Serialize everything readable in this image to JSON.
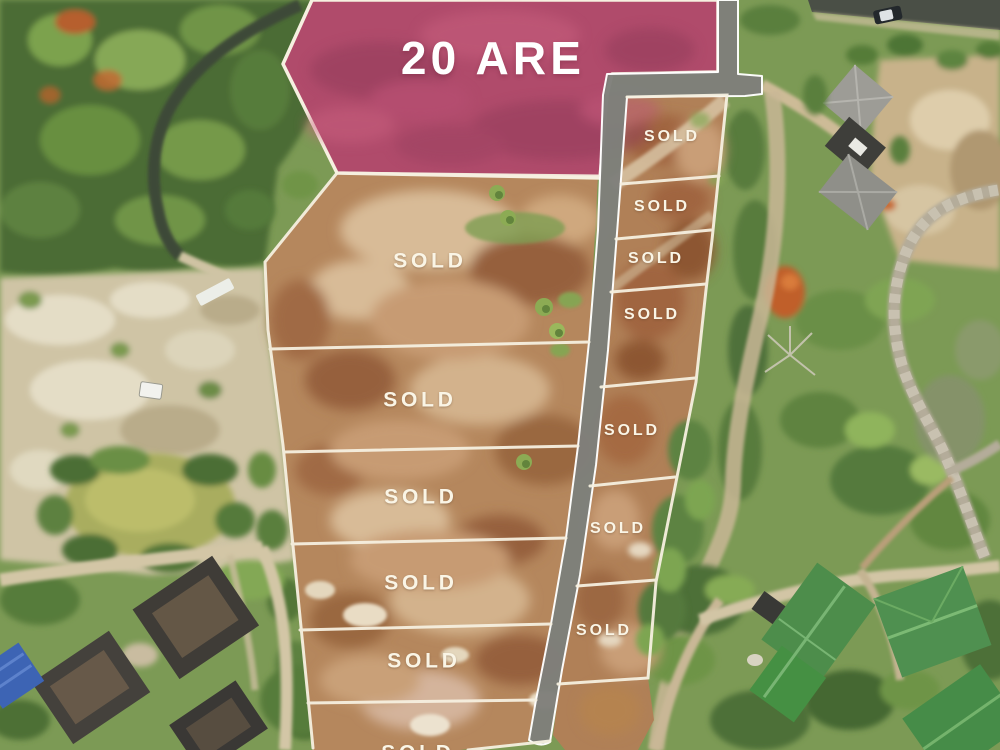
{
  "overlay": {
    "featured_plot": {
      "label": "20 ARE",
      "x": 493,
      "y": 58,
      "font_size": 46
    },
    "sold_plots_left": [
      {
        "label": "SOLD",
        "x": 430,
        "y": 261,
        "font_size": 21
      },
      {
        "label": "SOLD",
        "x": 420,
        "y": 400,
        "font_size": 21
      },
      {
        "label": "SOLD",
        "x": 421,
        "y": 497,
        "font_size": 21
      },
      {
        "label": "SOLD",
        "x": 421,
        "y": 583,
        "font_size": 21
      },
      {
        "label": "SOLD",
        "x": 424,
        "y": 661,
        "font_size": 21
      },
      {
        "label": "SOLD",
        "x": 418,
        "y": 753,
        "font_size": 21
      }
    ],
    "sold_plots_right": [
      {
        "label": "SOLD",
        "x": 672,
        "y": 137,
        "font_size": 16
      },
      {
        "label": "SOLD",
        "x": 662,
        "y": 207,
        "font_size": 16
      },
      {
        "label": "SOLD",
        "x": 656,
        "y": 259,
        "font_size": 16
      },
      {
        "label": "SOLD",
        "x": 652,
        "y": 315,
        "font_size": 16
      },
      {
        "label": "SOLD",
        "x": 632,
        "y": 431,
        "font_size": 16
      },
      {
        "label": "SOLD",
        "x": 618,
        "y": 529,
        "font_size": 16
      },
      {
        "label": "SOLD",
        "x": 604,
        "y": 631,
        "font_size": 16
      }
    ],
    "colors": {
      "featured_fill": "#b04b6b",
      "road_fill": "#7f7f7b",
      "boundary_line": "#f6f0e0",
      "label_text": "#faf5e6",
      "featured_label_text": "#ffffff"
    }
  }
}
